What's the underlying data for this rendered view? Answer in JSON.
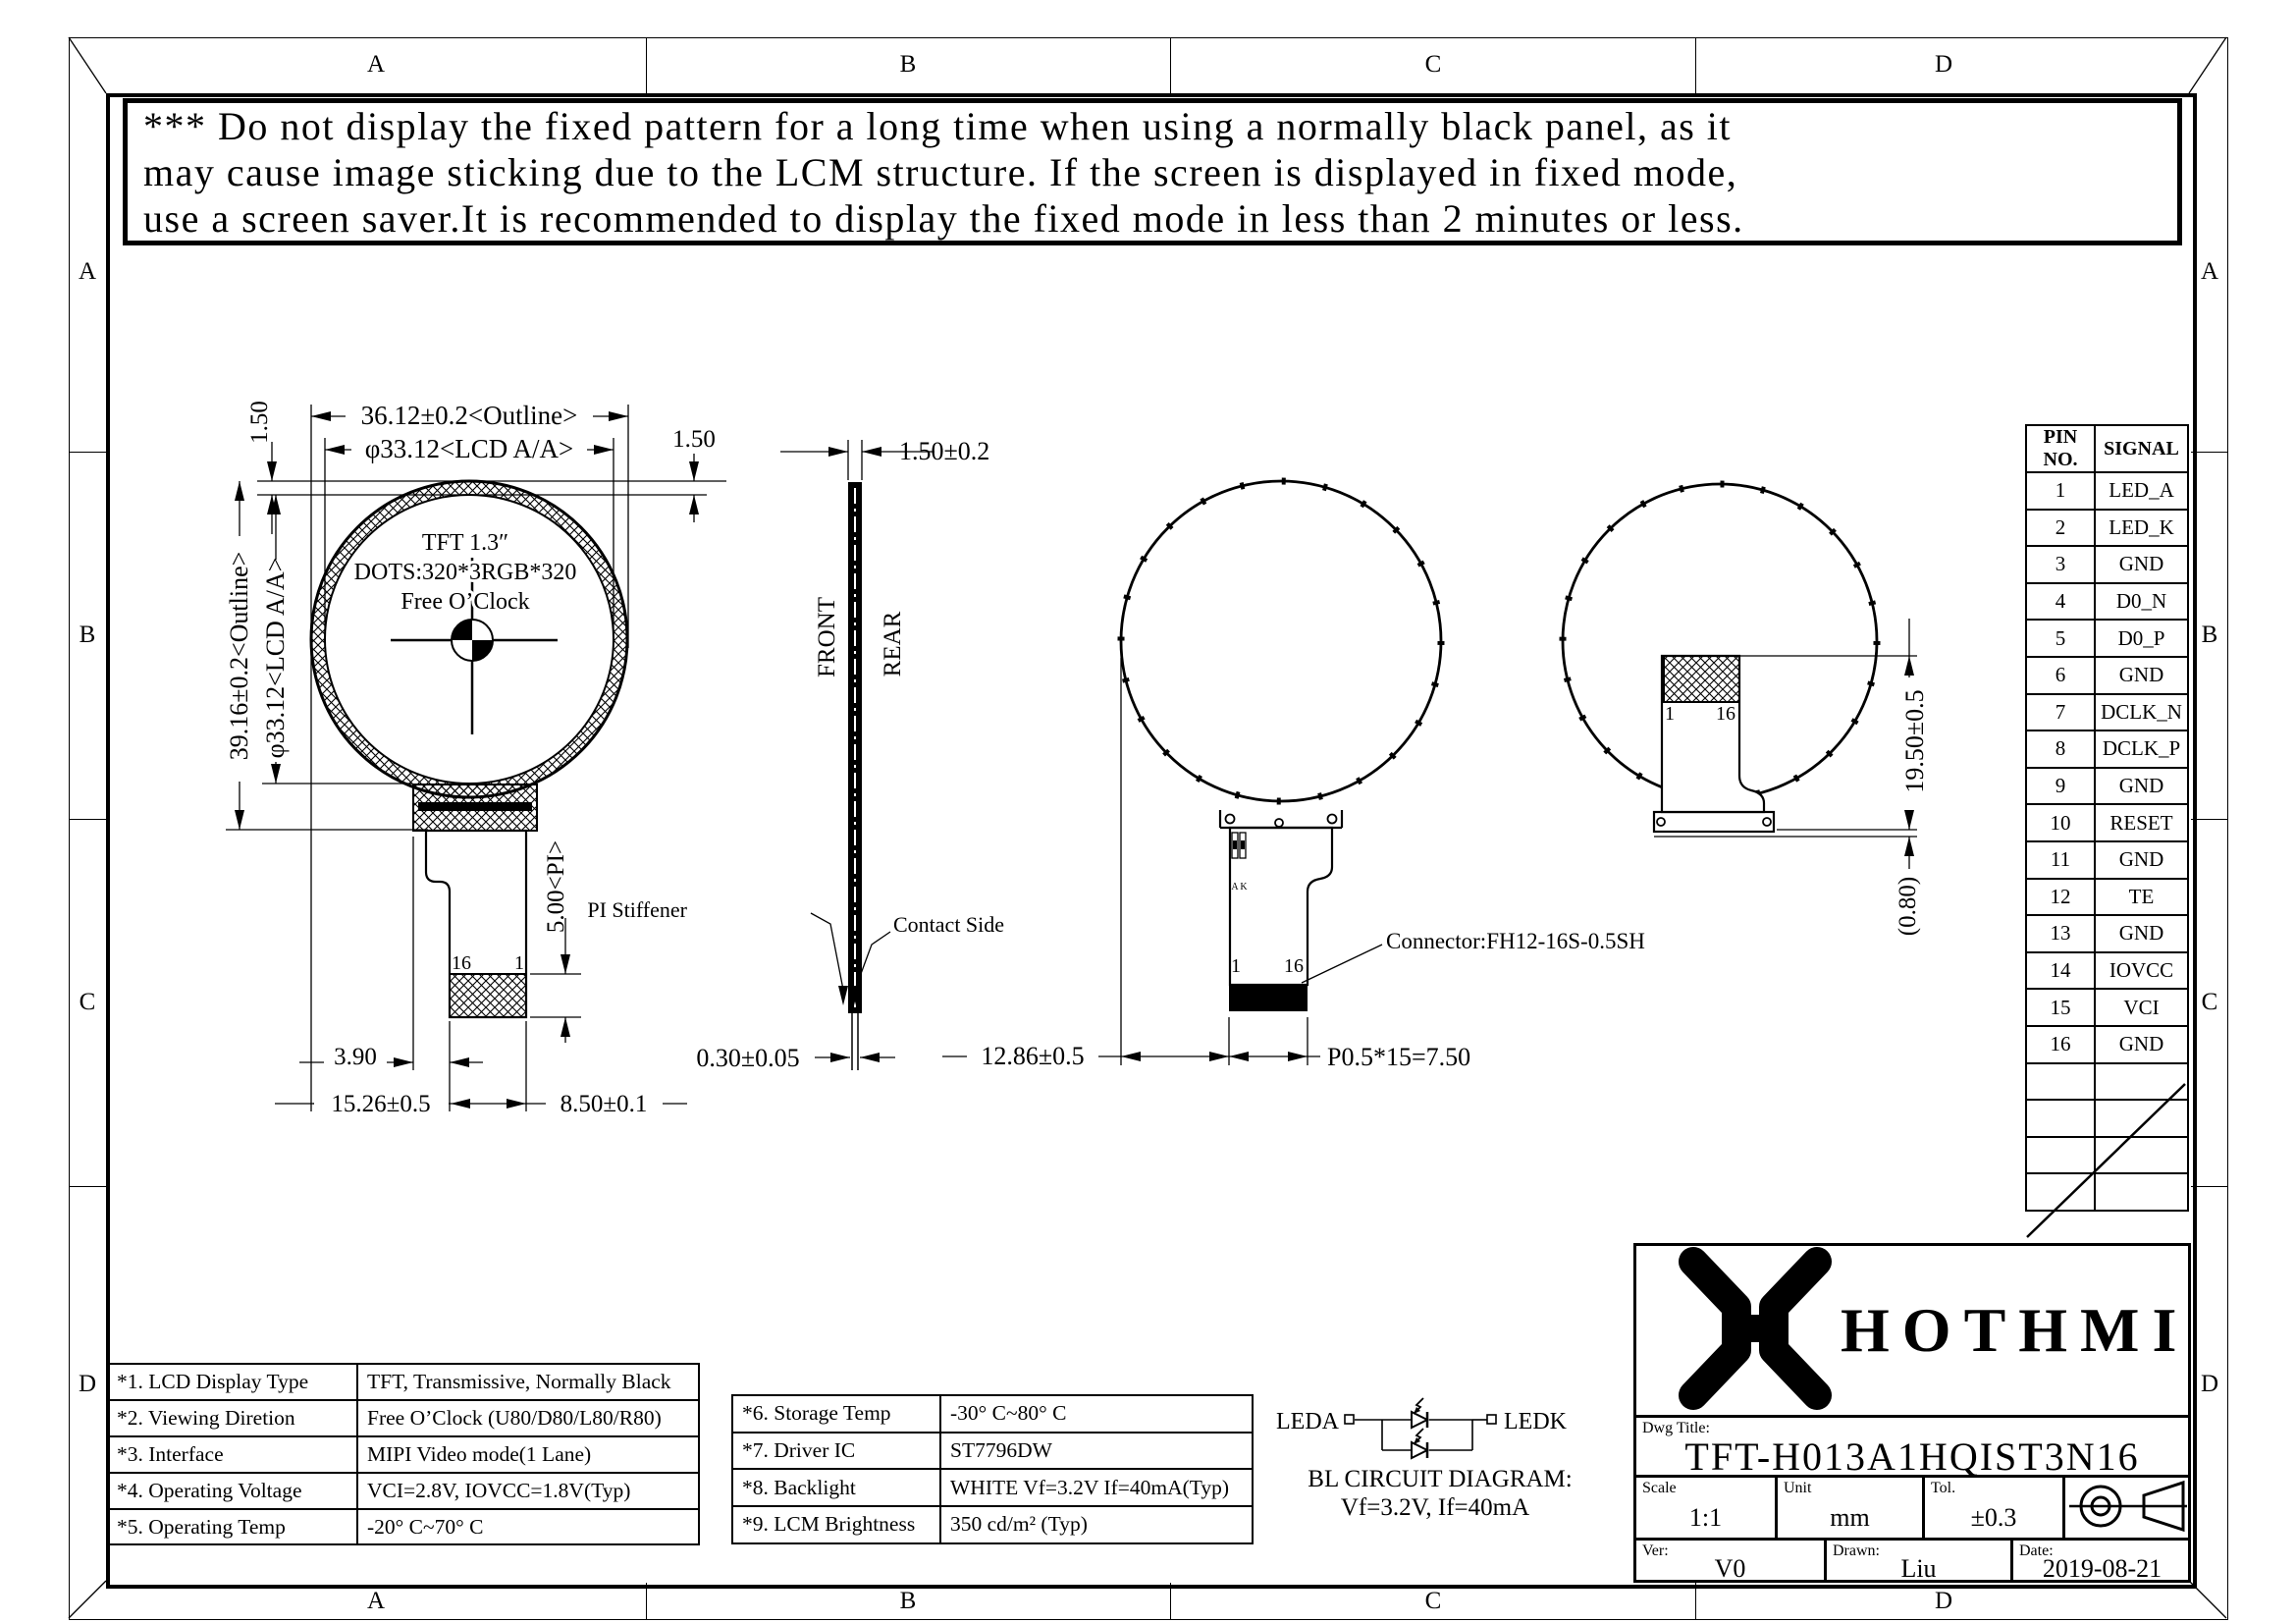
{
  "border": {
    "cols": [
      "A",
      "B",
      "C",
      "D"
    ],
    "rows": [
      "A",
      "B",
      "C",
      "D"
    ]
  },
  "warning": {
    "lines": [
      "*** Do not display the fixed pattern for a long time when using a normally black panel, as it",
      "may cause image sticking due to the LCM structure.  If the screen is displayed in fixed mode,",
      "use a screen saver.It is recommended to display the fixed mode in less than 2 minutes or less."
    ]
  },
  "front_view": {
    "dim_outline_w": "36.12±0.2<Outline>",
    "dim_lcd_w": "φ33.12<LCD A/A>",
    "dim_ring": "1.50",
    "dim_gap": "1.50",
    "dim_outline_h": "39.16±0.2<Outline>",
    "dim_lcd_h": "φ33.12<LCD A/A>",
    "label_size": "TFT 1.3″",
    "label_dots": "DOTS:320*3RGB*320",
    "label_clock": "Free O’Clock",
    "pin16": "16",
    "pin1": "1",
    "dim_pi": "5.00<PI>",
    "dim_390": "3.90",
    "dim_1526": "15.26±0.5",
    "dim_850": "8.50±0.1"
  },
  "side_view": {
    "front": "FRONT",
    "rear": "REAR",
    "dim_thickness": "1.50±0.2",
    "label_pi": "PI Stiffener",
    "label_contact": "Contact Side",
    "dim_fpc": "0.30±0.05"
  },
  "rear_view": {
    "pin1": "1",
    "pin16": "16",
    "led_a": "A",
    "led_k": "K",
    "label_connector": "Connector:FH12-16S-0.5SH",
    "dim_width": "12.86±0.5",
    "dim_pitch": "P0.5*15=7.50"
  },
  "folded_view": {
    "pin1": "1",
    "pin16": "16",
    "dim_height": "19.50±0.5",
    "dim_gap": "(0.80)"
  },
  "pin_table": {
    "headers": [
      "PIN NO.",
      "SIGNAL"
    ],
    "rows": [
      [
        "1",
        "LED_A"
      ],
      [
        "2",
        "LED_K"
      ],
      [
        "3",
        "GND"
      ],
      [
        "4",
        "D0_N"
      ],
      [
        "5",
        "D0_P"
      ],
      [
        "6",
        "GND"
      ],
      [
        "7",
        "DCLK_N"
      ],
      [
        "8",
        "DCLK_P"
      ],
      [
        "9",
        "GND"
      ],
      [
        "10",
        "RESET"
      ],
      [
        "11",
        "GND"
      ],
      [
        "12",
        "TE"
      ],
      [
        "13",
        "GND"
      ],
      [
        "14",
        "IOVCC"
      ],
      [
        "15",
        "VCI"
      ],
      [
        "16",
        "GND"
      ]
    ]
  },
  "spec_left": {
    "rows": [
      [
        "*1.  LCD Display Type",
        "TFT, Transmissive, Normally Black"
      ],
      [
        "*2.  Viewing Diretion",
        "Free O’Clock (U80/D80/L80/R80)"
      ],
      [
        "*3.  Interface",
        "MIPI Video mode(1 Lane)"
      ],
      [
        "*4.  Operating Voltage",
        "VCI=2.8V, IOVCC=1.8V(Typ)"
      ],
      [
        "*5.  Operating Temp",
        "-20° C~70° C"
      ]
    ]
  },
  "spec_right": {
    "rows": [
      [
        "*6.  Storage Temp",
        "-30° C~80° C"
      ],
      [
        "*7.  Driver IC",
        "ST7796DW"
      ],
      [
        "*8.  Backlight",
        "WHITE Vf=3.2V If=40mA(Typ)"
      ],
      [
        "*9.  LCM Brightness",
        "350 cd/m² (Typ)"
      ]
    ]
  },
  "bl_circuit": {
    "leda": "LEDA",
    "ledk": "LEDK",
    "title": "BL CIRCUIT DIAGRAM:",
    "subtitle": "Vf=3.2V, If=40mA"
  },
  "title_block": {
    "brand": "HOTHMI",
    "dwg_title_label": "Dwg Title:",
    "dwg_title": "TFT-H013A1HQIST3N16",
    "scale_label": "Scale",
    "scale_value": "1:1",
    "unit_label": "Unit",
    "unit_value": "mm",
    "tol_label": "Tol.",
    "tol_value": "±0.3",
    "ver_label": "Ver:",
    "ver_value": "V0",
    "drawn_label": "Drawn:",
    "drawn_value": "Liu",
    "date_label": "Date:",
    "date_value": "2019-08-21"
  }
}
